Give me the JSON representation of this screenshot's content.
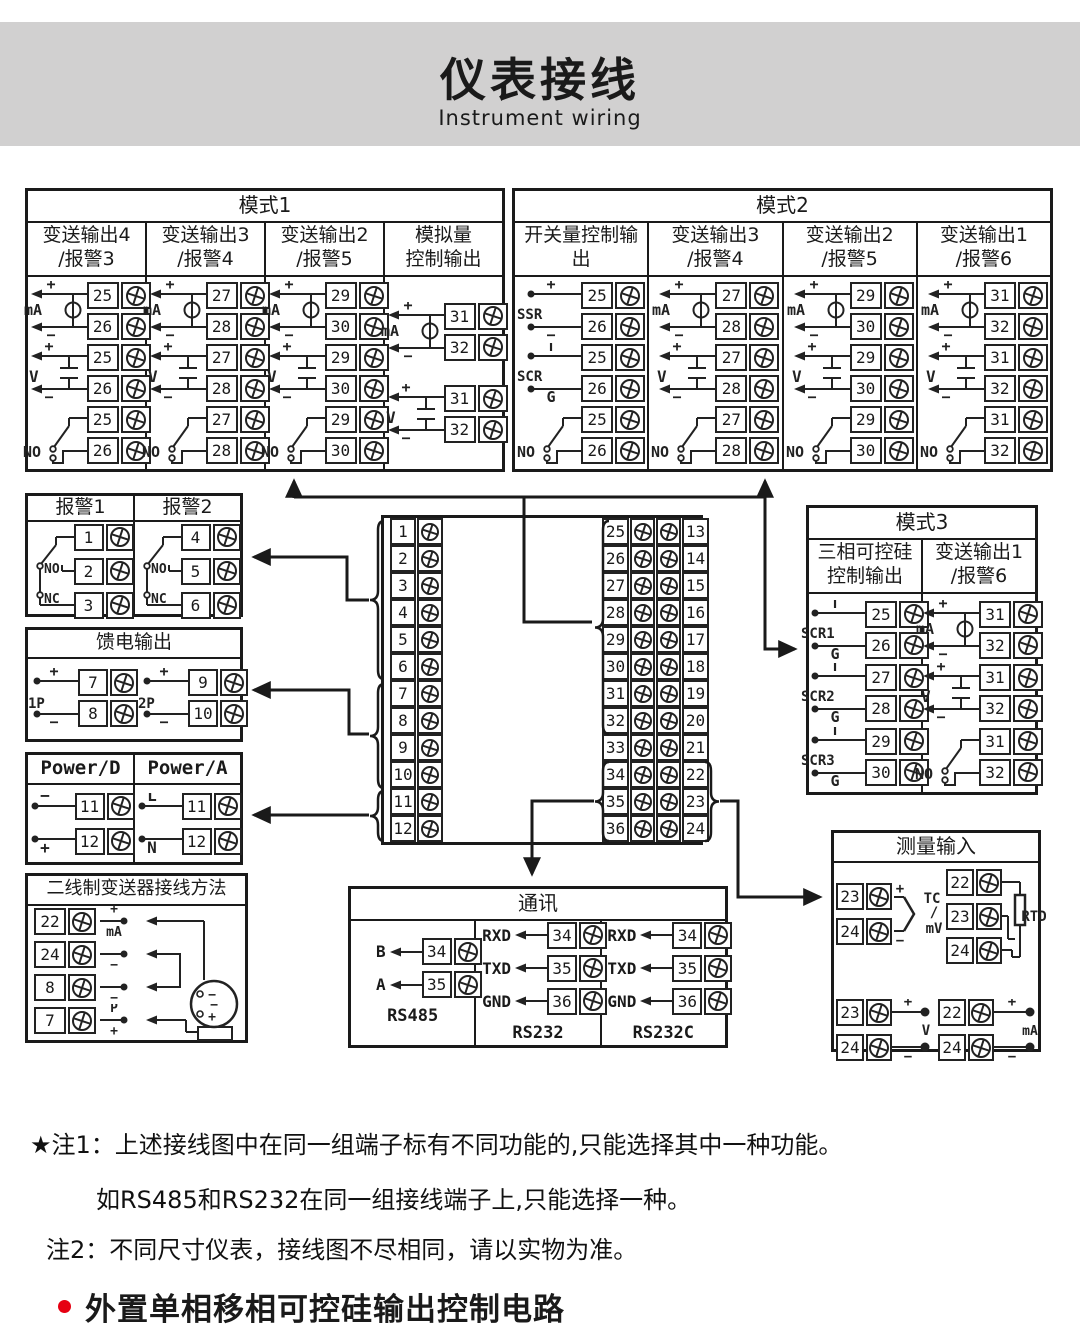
{
  "colors": {
    "band": "#d1d0d0",
    "line": "#222222",
    "accent_red": "#e60012"
  },
  "header": {
    "title": "仪表接线",
    "subtitle": "Instrument wiring"
  },
  "mode1": {
    "title": "模式1",
    "columns": [
      {
        "title": "变送输出4\n/报警3",
        "groups": [
          {
            "sym": "source",
            "label": "mA",
            "top": "+",
            "bot": "−",
            "terminals": [
              "25",
              "26"
            ]
          },
          {
            "sym": "volt",
            "label": "V",
            "top": "+",
            "bot": "−",
            "terminals": [
              "25",
              "26"
            ]
          },
          {
            "sym": "switch",
            "label": "NO",
            "terminals": [
              "25",
              "26"
            ]
          }
        ]
      },
      {
        "title": "变送输出3\n/报警4",
        "groups": [
          {
            "sym": "source",
            "label": "mA",
            "top": "+",
            "bot": "−",
            "terminals": [
              "27",
              "28"
            ]
          },
          {
            "sym": "volt",
            "label": "V",
            "top": "+",
            "bot": "−",
            "terminals": [
              "27",
              "28"
            ]
          },
          {
            "sym": "switch",
            "label": "NO",
            "terminals": [
              "27",
              "28"
            ]
          }
        ]
      },
      {
        "title": "变送输出2\n/报警5",
        "groups": [
          {
            "sym": "source",
            "label": "mA",
            "top": "+",
            "bot": "−",
            "terminals": [
              "29",
              "30"
            ]
          },
          {
            "sym": "volt",
            "label": "V",
            "top": "+",
            "bot": "−",
            "terminals": [
              "29",
              "30"
            ]
          },
          {
            "sym": "switch",
            "label": "NO",
            "terminals": [
              "29",
              "30"
            ]
          }
        ]
      },
      {
        "title": "模拟量\n控制输出",
        "groups": [
          {
            "sym": "source",
            "label": "mA",
            "top": "+",
            "bot": "−",
            "terminals": [
              "31",
              "32"
            ]
          },
          {
            "sym": "volt",
            "label": "V",
            "top": "+",
            "bot": "−",
            "terminals": [
              "31",
              "32"
            ]
          }
        ]
      }
    ]
  },
  "mode2": {
    "title": "模式2",
    "columns": [
      {
        "title": "开关量控制输出",
        "groups": [
          {
            "sym": "dots",
            "label": "SSR",
            "top": "+",
            "bot": "−",
            "terminals": [
              "25",
              "26"
            ]
          },
          {
            "sym": "dots",
            "label": "SCR",
            "top": "T",
            "bot": "G",
            "terminals": [
              "25",
              "26"
            ]
          },
          {
            "sym": "switch",
            "label": "NO",
            "terminals": [
              "25",
              "26"
            ]
          }
        ]
      },
      {
        "title": "变送输出3\n/报警4",
        "groups": [
          {
            "sym": "source",
            "label": "mA",
            "top": "+",
            "bot": "−",
            "terminals": [
              "27",
              "28"
            ]
          },
          {
            "sym": "volt",
            "label": "V",
            "top": "+",
            "bot": "−",
            "terminals": [
              "27",
              "28"
            ]
          },
          {
            "sym": "switch",
            "label": "NO",
            "terminals": [
              "27",
              "28"
            ]
          }
        ]
      },
      {
        "title": "变送输出2\n/报警5",
        "groups": [
          {
            "sym": "source",
            "label": "mA",
            "top": "+",
            "bot": "−",
            "terminals": [
              "29",
              "30"
            ]
          },
          {
            "sym": "volt",
            "label": "V",
            "top": "+",
            "bot": "−",
            "terminals": [
              "29",
              "30"
            ]
          },
          {
            "sym": "switch",
            "label": "NO",
            "terminals": [
              "29",
              "30"
            ]
          }
        ]
      },
      {
        "title": "变送输出1\n/报警6",
        "groups": [
          {
            "sym": "source",
            "label": "mA",
            "top": "+",
            "bot": "−",
            "terminals": [
              "31",
              "32"
            ]
          },
          {
            "sym": "volt",
            "label": "V",
            "top": "+",
            "bot": "−",
            "terminals": [
              "31",
              "32"
            ]
          },
          {
            "sym": "switch",
            "label": "NO",
            "terminals": [
              "31",
              "32"
            ]
          }
        ]
      }
    ]
  },
  "mode3": {
    "title": "模式3",
    "columns": [
      {
        "title": "三相可控硅\n控制输出",
        "groups": [
          {
            "sym": "dots",
            "label": "SCR1",
            "top": "T",
            "bot": "G",
            "terminals": [
              "25",
              "26"
            ]
          },
          {
            "sym": "dots",
            "label": "SCR2",
            "top": "T",
            "bot": "G",
            "terminals": [
              "27",
              "28"
            ]
          },
          {
            "sym": "dots",
            "label": "SCR3",
            "top": "T",
            "bot": "G",
            "terminals": [
              "29",
              "30"
            ]
          }
        ]
      },
      {
        "title": "变送输出1\n/报警6",
        "groups": [
          {
            "sym": "source",
            "label": "mA",
            "top": "+",
            "bot": "−",
            "terminals": [
              "31",
              "32"
            ]
          },
          {
            "sym": "volt",
            "label": "V",
            "top": "+",
            "bot": "−",
            "terminals": [
              "31",
              "32"
            ]
          },
          {
            "sym": "switch",
            "label": "NO",
            "terminals": [
              "31",
              "32"
            ]
          }
        ]
      }
    ]
  },
  "alarm": {
    "columns": [
      {
        "title": "报警1",
        "no": "NO",
        "nc": "NC",
        "terminals": [
          "1",
          "2",
          "3"
        ]
      },
      {
        "title": "报警2",
        "no": "NO",
        "nc": "NC",
        "terminals": [
          "4",
          "5",
          "6"
        ]
      }
    ]
  },
  "feed": {
    "title": "馈电输出",
    "groups": [
      {
        "label": "1P",
        "top": "+",
        "bot": "−",
        "terminals": [
          "7",
          "8"
        ]
      },
      {
        "label": "2P",
        "top": "+",
        "bot": "−",
        "terminals": [
          "9",
          "10"
        ]
      }
    ]
  },
  "power": {
    "columns": [
      {
        "title": "Power/D",
        "top": "−",
        "bot": "+",
        "terminals": [
          "11",
          "12"
        ]
      },
      {
        "title": "Power/A",
        "top": "L",
        "bot": "N",
        "terminals": [
          "11",
          "12"
        ]
      }
    ]
  },
  "twowire": {
    "title": "二线制变送器接线方法",
    "rows": [
      {
        "n": "22",
        "above": "+",
        "below": "mA"
      },
      {
        "n": "24",
        "above": "",
        "below": "−"
      },
      {
        "n": "8",
        "above": "",
        "below": "−"
      },
      {
        "n": "7",
        "above": "P",
        "below": "+"
      }
    ],
    "transmitter": {
      "t1": "−",
      "t2": "−",
      "t3": "+"
    }
  },
  "block": {
    "left": [
      "1",
      "2",
      "3",
      "4",
      "5",
      "6",
      "7",
      "8",
      "9",
      "10",
      "11",
      "12"
    ],
    "right": [
      [
        "25",
        "13"
      ],
      [
        "26",
        "14"
      ],
      [
        "27",
        "15"
      ],
      [
        "28",
        "16"
      ],
      [
        "29",
        "17"
      ],
      [
        "30",
        "18"
      ],
      [
        "31",
        "19"
      ],
      [
        "32",
        "20"
      ],
      [
        "33",
        "21"
      ],
      [
        "34",
        "22"
      ],
      [
        "35",
        "23"
      ],
      [
        "36",
        "24"
      ]
    ]
  },
  "comm": {
    "title": "通讯",
    "columns": [
      {
        "name": "RS485",
        "pins": [
          {
            "label": "B",
            "n": "34"
          },
          {
            "label": "A",
            "n": "35"
          }
        ]
      },
      {
        "name": "RS232",
        "pins": [
          {
            "label": "RXD",
            "n": "34"
          },
          {
            "label": "TXD",
            "n": "35"
          },
          {
            "label": "GND",
            "n": "36"
          }
        ]
      },
      {
        "name": "RS232C",
        "pins": [
          {
            "label": "RXD",
            "n": "34"
          },
          {
            "label": "TXD",
            "n": "35"
          },
          {
            "label": "GND",
            "n": "36"
          }
        ]
      }
    ]
  },
  "measure": {
    "title": "测量输入",
    "tc": {
      "rows": [
        "23",
        "24"
      ],
      "plus": "+",
      "minus": "−",
      "label1": "TC",
      "label2": "/",
      "label3": "mV"
    },
    "rtd": {
      "rows": [
        "22",
        "23",
        "24"
      ],
      "label": "RTD"
    },
    "v": {
      "rows": [
        "23",
        "24"
      ],
      "plus": "+",
      "minus": "−",
      "label": "V"
    },
    "ma": {
      "rows": [
        "22",
        "24"
      ],
      "plus": "+",
      "minus": "−",
      "label": "mA"
    }
  },
  "notes": [
    {
      "text": "★注1：上述接线图中在同一组端子标有不同功能的,只能选择其中一种功能。"
    },
    {
      "text": "如RS485和RS232在同一组接线端子上,只能选择一种。"
    },
    {
      "text": "注2：不同尺寸仪表，接线图不尽相同，请以实物为准。"
    }
  ],
  "bullet": {
    "text": "外置单相移相可控硅输出控制电路"
  }
}
